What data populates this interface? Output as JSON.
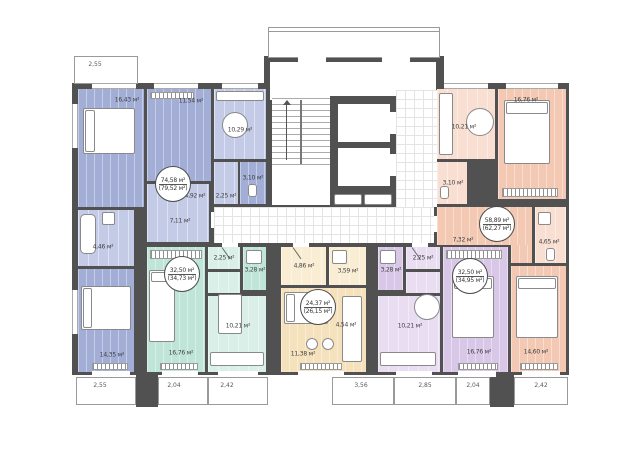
{
  "plan_title": "residential floor plan",
  "colors": {
    "walls": "#515151",
    "apt_blue": "#a2aed6",
    "apt_green": "#bfe5d8",
    "apt_cream": "#f5e1bb",
    "apt_purple": "#d9c7e7",
    "apt_salmon": "#f3c9b3"
  },
  "apartments": [
    {
      "id": "apt-blue",
      "area_net": "74,58 м²",
      "area_gross": "(79,52 м²)",
      "rooms": [
        "16,43 м²",
        "11,54 м²",
        "10,29 м²",
        "3,10 м²",
        "2,25 м²",
        "4,92 м²",
        "7,11 м²",
        "4,46 м²",
        "14,35 м²"
      ]
    },
    {
      "id": "apt-green",
      "area_net": "32,50 м²",
      "area_gross": "(34,73 м²)",
      "rooms": [
        "2,25 м²",
        "3,28 м²",
        "10,21 м²",
        "16,76 м²"
      ]
    },
    {
      "id": "apt-cream",
      "area_net": "24,37 м²",
      "area_gross": "(26,15 м²)",
      "rooms": [
        "4,86 м²",
        "3,59 м²",
        "4,54 м²",
        "11,38 м²"
      ]
    },
    {
      "id": "apt-purple",
      "area_net": "32,50 м²",
      "area_gross": "(34,95 м²)",
      "rooms": [
        "3,28 м²",
        "2,25 м²",
        "10,21 м²",
        "16,76 м²"
      ]
    },
    {
      "id": "apt-salmon",
      "area_net": "58,89 м²",
      "area_gross": "(62,27 м²)",
      "rooms": [
        "10,21 м²",
        "16,76 м²",
        "3,10 м²",
        "7,32 м²",
        "4,65 м²",
        "14,60 м²"
      ]
    }
  ],
  "dimensions": {
    "top_left": "2,55",
    "bottom": [
      "2,55",
      "2,04",
      "2,42",
      "3,56",
      "2,85",
      "2,04",
      "2,42"
    ]
  }
}
